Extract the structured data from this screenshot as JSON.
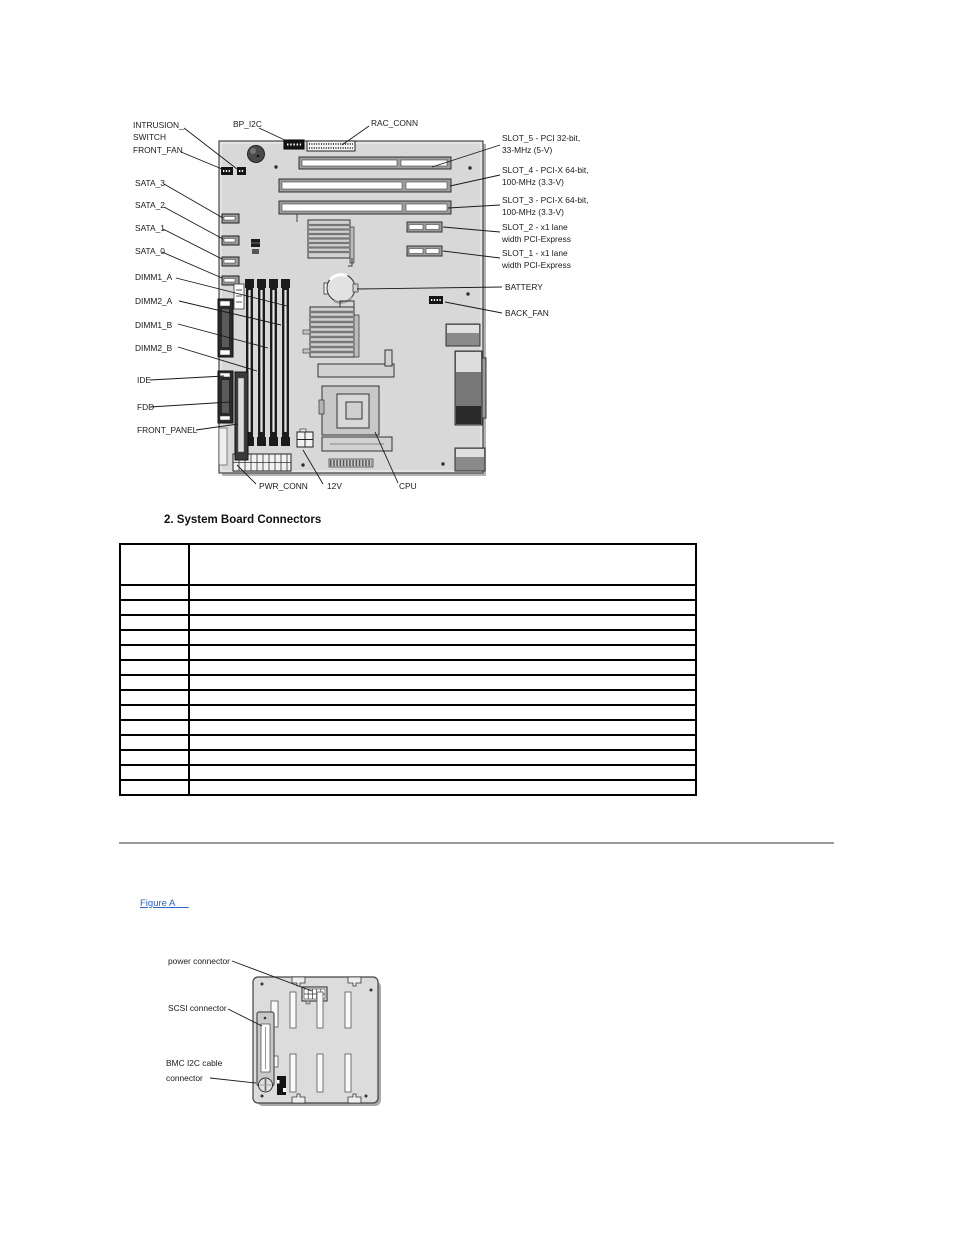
{
  "figure1": {
    "caption": "2. System Board Connectors",
    "labels": {
      "intrusion_line1": "INTRUSION_",
      "intrusion_line2": "SWITCH",
      "front_fan": "FRONT_FAN",
      "sata_3": "SATA_3",
      "sata_2": "SATA_2",
      "sata_1": "SATA_1",
      "sata_0": "SATA_0",
      "dimm1_a": "DIMM1_A",
      "dimm2_a": "DIMM2_A",
      "dimm1_b": "DIMM1_B",
      "dimm2_b": "DIMM2_B",
      "ide": "IDE",
      "fdd": "FDD",
      "front_panel": "FRONT_PANEL",
      "bp_i2c": "BP_I2C",
      "rac_conn": "RAC_CONN",
      "slot5_line1": "SLOT_5 - PCI 32-bit,",
      "slot5_line2": "33-MHz (5-V)",
      "slot4_line1": "SLOT_4 - PCI-X 64-bit,",
      "slot4_line2": "100-MHz (3.3-V)",
      "slot3_line1": "SLOT_3 - PCI-X 64-bit,",
      "slot3_line2": "100-MHz (3.3-V)",
      "slot2_line1": "SLOT_2 - x1 lane",
      "slot2_line2": "width PCI-Express",
      "slot1_line1": "SLOT_1 - x1 lane",
      "slot1_line2": "width PCI-Express",
      "battery": "BATTERY",
      "back_fan": "BACK_FAN",
      "pwr_conn": "PWR_CONN",
      "twelve_v": "12V",
      "cpu": "CPU"
    }
  },
  "connectors_table": {
    "header": [
      "",
      ""
    ],
    "body_row_count": 14
  },
  "links": {
    "figure_a": "Figure A"
  },
  "figure2": {
    "labels": {
      "power_connector": "power connector",
      "scsi_connector": "SCSI connector",
      "bmc_line1": "BMC I2C cable",
      "bmc_line2": "connector"
    }
  },
  "colors": {
    "link_blue": "#2b64c5",
    "divider_gray": "#9b9b9b",
    "table_border": "#000000",
    "board_fill": "#d8d8d8",
    "diagram_text": "#1a1a1a"
  }
}
